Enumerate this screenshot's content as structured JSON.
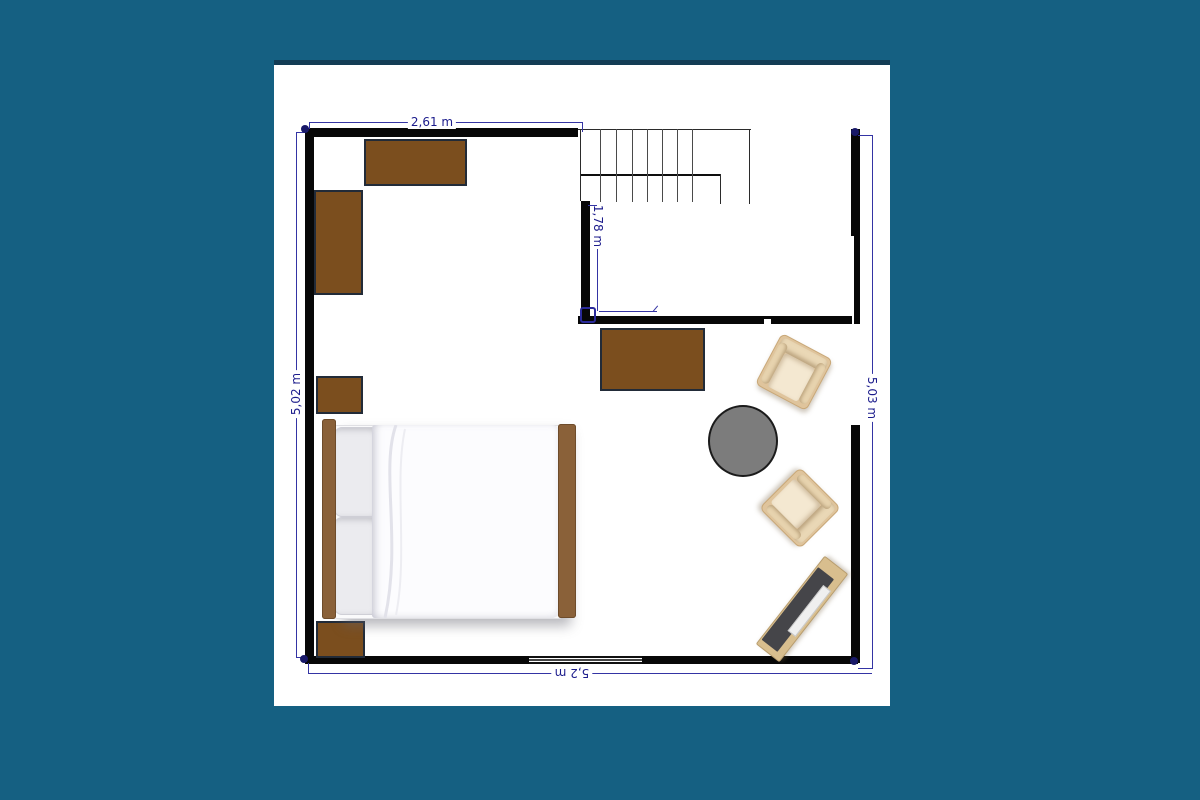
{
  "scene": {
    "background_color": "#156082",
    "canvas_color": "#ffffff",
    "canvas_top_border_color": "#133c55"
  },
  "floorplan": {
    "dimension_labels": {
      "top": "2,61 m",
      "left": "5,02 m",
      "right": "5,03 m",
      "bottom": "5,2 m",
      "interior": "1,78 m"
    },
    "colors": {
      "wall": "#070707",
      "dimension_line": "#3434a4",
      "dimension_text": "#1c1c8c",
      "furniture_brown": "#7b4e1e",
      "furniture_border": "#222b38",
      "bed_wood": "#8a6139",
      "bedding_white": "#fcfcfe",
      "pillow_gray": "#ebebef",
      "chair_beige": "#dfc49c",
      "chair_seat": "#f4e8d1",
      "table_gray": "#7c7c7c",
      "tv_board_tan": "#d8be8e",
      "tv_screen_dark": "#454549"
    },
    "furniture": [
      {
        "name": "dresser-top"
      },
      {
        "name": "wardrobe-left"
      },
      {
        "name": "cabinet-left-small"
      },
      {
        "name": "cabinet-bottom-left"
      },
      {
        "name": "double-bed"
      },
      {
        "name": "dresser-middle"
      },
      {
        "name": "armchair-upper"
      },
      {
        "name": "armchair-lower"
      },
      {
        "name": "round-side-table"
      },
      {
        "name": "tv-sideboard"
      },
      {
        "name": "staircase"
      },
      {
        "name": "window-bottom"
      }
    ]
  }
}
